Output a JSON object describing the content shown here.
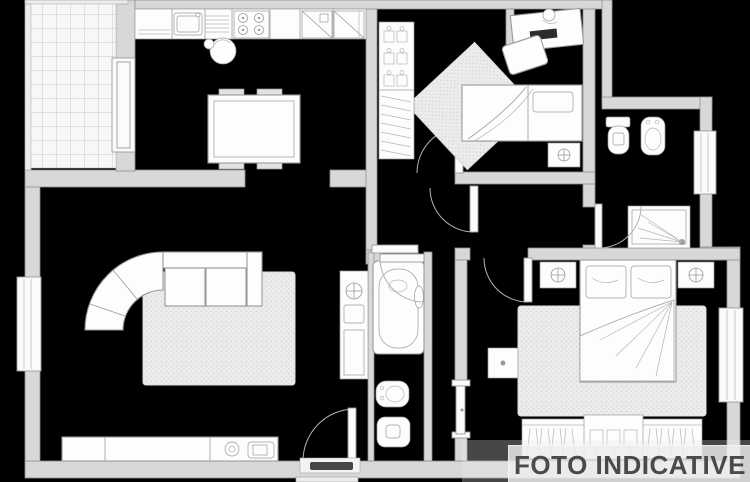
{
  "watermark": {
    "text": "FOTO INDICATIVE",
    "text_color": "#4a4a4a",
    "band_color": "rgba(238,238,238,0.82)"
  },
  "canvas": {
    "background": "#000000"
  },
  "plan_colors": {
    "wall_fill": "#d8d8d8",
    "wall_stroke": "#8f8f8f",
    "furniture_fill": "#fdfdfd",
    "furniture_stroke": "#9a9a9a",
    "rug_fill": "#ececec",
    "balcony_tile_fill": "#f7f7f7"
  }
}
